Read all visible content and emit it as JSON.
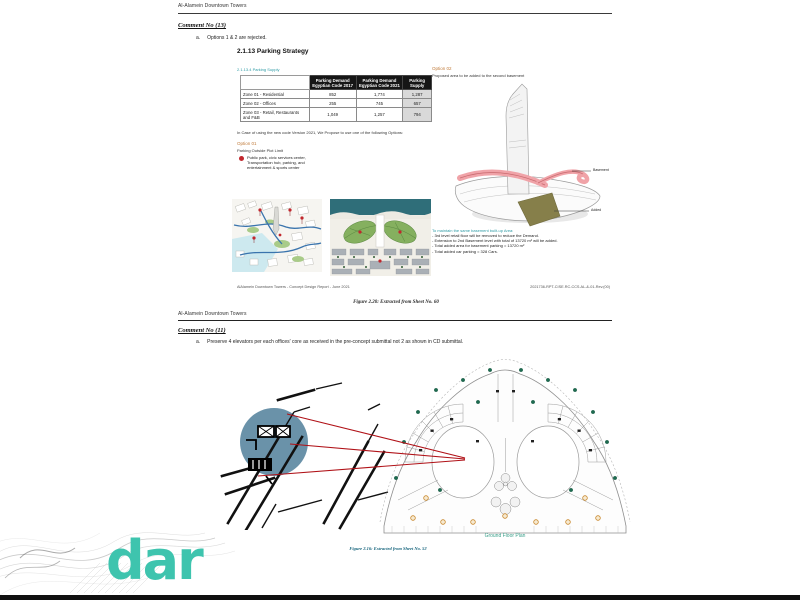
{
  "colors": {
    "accent_teal": "#3ec4ae",
    "heading_teal": "#2e9ba5",
    "option_orange": "#c07b3a",
    "bullet_red": "#c1272d",
    "callout_red": "#b01117",
    "highlight_circle_blue": "#5f8aa3",
    "added_olive": "#867f4a",
    "basement_pink": "#f0a3a8",
    "plan_caption_teal": "#3aa08a"
  },
  "page1": {
    "header": "Al-Alamein Downtown Towers",
    "comment": {
      "title": "Comment No (13)",
      "item_label": "a.",
      "item_text": "Options 1 & 2 are rejected."
    },
    "section_title": "2.1.13 Parking Strategy",
    "subsection_title": "2.1.13.4 Parking Supply",
    "table": {
      "headers": [
        "Parking Demand Egyptian Code 2017",
        "Parking Demand Egyptian Code 2021",
        "Parking Supply"
      ],
      "rows": [
        [
          "Zone 01 - Residential",
          "852",
          "1,774",
          "1,287"
        ],
        [
          "Zone 02 - Offices",
          "255",
          "745",
          "657"
        ],
        [
          "Zone 03 - Retail, Restaurants and F&B",
          "1,049",
          "1,257",
          "794"
        ]
      ]
    },
    "note": "In Case of using the new code Version 2021, We Propose to use one of the following Options:",
    "option1": {
      "title": "Option 01",
      "subtitle": "Parking Outside Plot Limit",
      "bullet": "Public park, civic services center, Transportation hub, parking, and entertainment & sports center"
    },
    "option2": {
      "title": "Option 02",
      "subtitle": "Proposed area to be added to the second basement",
      "label_basement": "Basement",
      "label_added": "Added"
    },
    "maintain": {
      "heading": "To maintain the same basement built-up Area:",
      "lines": [
        "- 3rd level retail floor will be removed to reduce the Demand.",
        "- Extension to 2nd Basement level with total of 13720 m² will be added.",
        "- Total added area for basement parking = 13720 m²",
        "- Total added car parking = 328 Cars."
      ]
    },
    "footer_left": "AlAlamein Downtown Towers - Concept Design Report - June 2021",
    "footer_right": "2021736-RPT-CISE.RC-CCS.AL-&-01-Rev.(00)",
    "figure_caption": "Figure 2.20: Extracted from Sheet No. 60"
  },
  "page2": {
    "header": "Al-Alamein Downtown Towers",
    "comment": {
      "title": "Comment No (11)",
      "item_label": "a.",
      "item_text": "Preserve 4 elevators per each offices' core as received in the pre-concept submittal not 2 as shown in CD submittal."
    },
    "plan_caption": "Ground Floor Plan",
    "figure_caption": "Figure 2.16: Extracted from Sheet No. 52"
  },
  "watermark": {
    "logo_text": "dar"
  }
}
